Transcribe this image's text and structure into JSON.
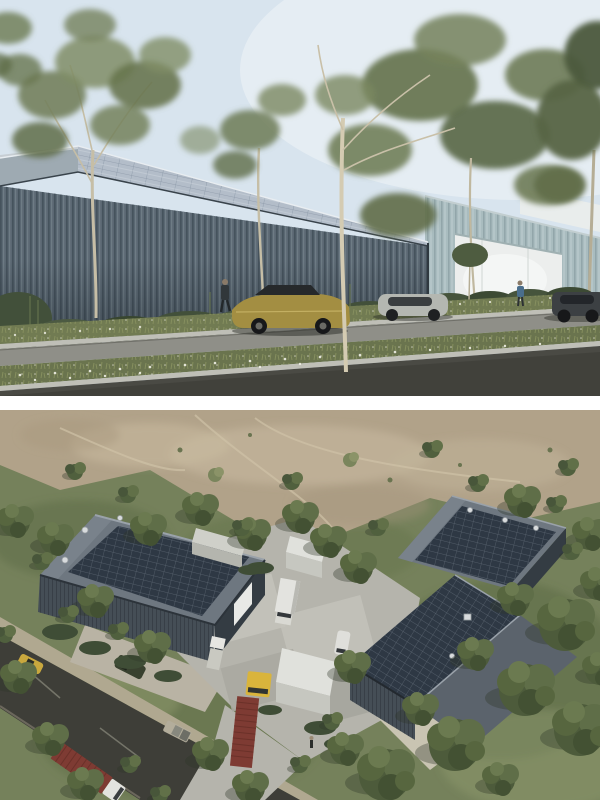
{
  "street_view": {
    "description": "Street-level architectural render of a long industrial shed with vertical metal cladding and a solar roof, eucalyptus street trees, wildflower verges, a gold sedan and other cars passing",
    "colors": {
      "sky": "#d8e4ee",
      "sky_glare": "#eef3f7",
      "distant_building": "#e9edec",
      "bg_building": "#a9bcbf",
      "bg_door": "#eceeed",
      "solar_roof": "#b3bdc9",
      "gable_end": "#9eaab2",
      "facade": "#5b6873",
      "shrub": "#42503a",
      "planting_strip": "#717b52",
      "curb": "#bfbfb7",
      "far_lane": "#8f8f88",
      "median_strip": "#6a744e",
      "near_lane": "#4a4a44",
      "trunk": "#cfc7ae",
      "trunk_light": "#d4cbb2",
      "car_gold": "#a38e42",
      "car_silver": "#b4b7b1",
      "car_dark": "#3c4043",
      "window": "#26292b",
      "pedestrian_shirt": "#4a6e8c",
      "daisy": "#efefe6"
    }
  },
  "aerial_view": {
    "description": "Aerial render of three dark gabled warehouses with rooftop solar arrays around a concrete courtyard, trucks and a red shipping container, a diagonal road, scattered eucalyptus trees and a dirt clearing",
    "colors": {
      "grass": "#75815b",
      "grass_light": "#97a171",
      "dirt": "#b1a289",
      "dirt_light": "#c6b89e",
      "road": "#3e3e38",
      "road_verge": "#b0a890",
      "apron": "#b9b3a4",
      "courtyard": "#b5b4ac",
      "paving": "#c4c3bb",
      "gravel": "#c9c4b2",
      "roof": "#6e7780",
      "roof_dark": "#5b636c",
      "ridge": "#9aa2aa",
      "solar": "#2e3844",
      "wall": "#454e56",
      "wall_dark": "#343c43",
      "door_white": "#e8e9e6",
      "white_top": "#e0e1dc",
      "white_face": "#c6c7c0",
      "container_red": "#7e3b33",
      "cab_yellow": "#d9b43c",
      "truck_white": "#e3e3df",
      "car_yellow": "#c9a83e",
      "suv_green": "#39412f",
      "pickup": "#b3ad9b",
      "vent": "#d8dbdd"
    }
  }
}
